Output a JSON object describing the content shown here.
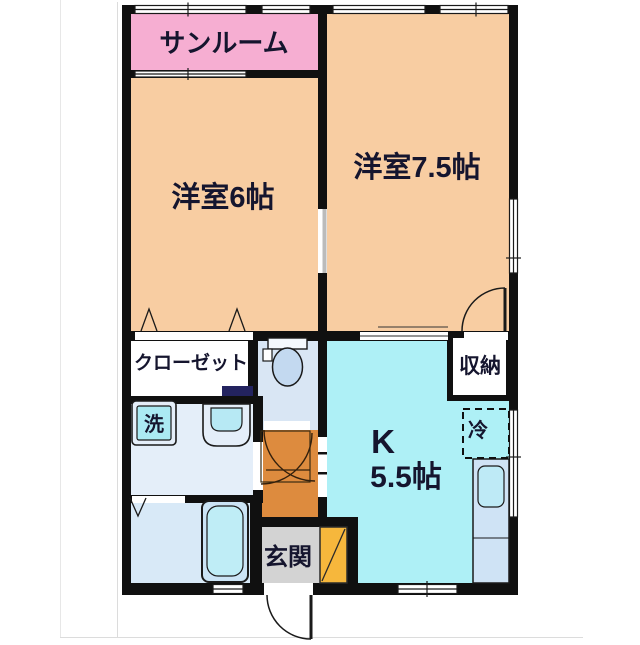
{
  "floorplan": {
    "rooms": {
      "sunroom": "サンルーム",
      "bedroom6": "洋室6帖",
      "bedroom75": "洋室7.5帖",
      "kitchen_k": "K",
      "kitchen_size": "5.5帖",
      "closet": "クローゼット",
      "storage": "収納",
      "entrance": "玄関"
    },
    "fixtures": {
      "washer": "洗",
      "fridge": "冷"
    },
    "colors": {
      "wall": "#101010",
      "bedroom_floor": "#F8CDA2",
      "sunroom_floor": "#F6AED2",
      "kitchen_floor": "#AEF0F6",
      "hallway_floor": "#DD8B3E",
      "entrance_floor": "#D3D3D3",
      "shoe_cabinet": "#F6B73C",
      "wet_area_floor": "#E0EBF7",
      "toilet_floor": "#D9E6F4",
      "tub_fill": "#BFEDF6",
      "accent_wall": "#23235F",
      "label_text": "#15152E"
    }
  }
}
